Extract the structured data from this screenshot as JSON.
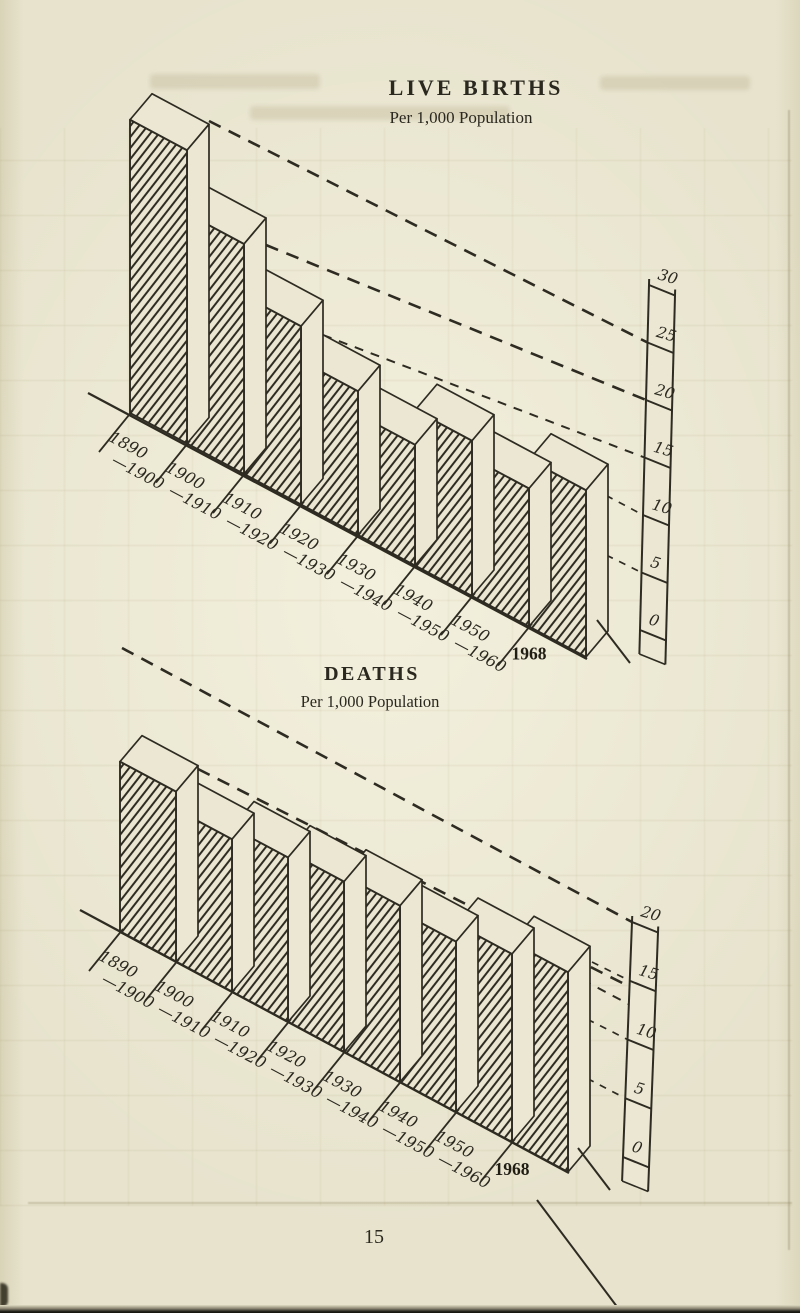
{
  "page": {
    "number": "15"
  },
  "chart_data": [
    {
      "type": "bar",
      "projection": "oblique-3d",
      "title": "LIVE BIRTHS",
      "subtitle": "Per 1,000 Population",
      "categories": [
        "1890–1900",
        "1900–1910",
        "1910–1920",
        "1920–1930",
        "1930–1940",
        "1940–1950",
        "1950–1960",
        "1968"
      ],
      "category_labels": [
        {
          "top": "1890",
          "bottom": "—1900"
        },
        {
          "top": "1900",
          "bottom": "—1910"
        },
        {
          "top": "1910",
          "bottom": "—1920"
        },
        {
          "top": "1920",
          "bottom": "—1930"
        },
        {
          "top": "1930",
          "bottom": "—1940"
        },
        {
          "top": "1940",
          "bottom": "—1950"
        },
        {
          "top": "1950",
          "bottom": "—1960"
        },
        {
          "top": "1968",
          "bottom": ""
        }
      ],
      "values": [
        25.5,
        20,
        15.5,
        12.5,
        10.5,
        13.5,
        12,
        14.5
      ],
      "ylim": [
        0,
        30
      ],
      "yticks": [
        0,
        5,
        10,
        15,
        20,
        25,
        30
      ],
      "grid": false,
      "legend": "none"
    },
    {
      "type": "bar",
      "projection": "oblique-3d",
      "title": "DEATHS",
      "subtitle": "Per 1,000 Population",
      "categories": [
        "1890–1900",
        "1900–1910",
        "1910–1920",
        "1920–1930",
        "1930–1940",
        "1940–1950",
        "1950–1960",
        "1968"
      ],
      "category_labels": [
        {
          "top": "1890",
          "bottom": "—1900"
        },
        {
          "top": "1900",
          "bottom": "—1910"
        },
        {
          "top": "1910",
          "bottom": "—1920"
        },
        {
          "top": "1920",
          "bottom": "—1930"
        },
        {
          "top": "1930",
          "bottom": "—1940"
        },
        {
          "top": "1940",
          "bottom": "—1950"
        },
        {
          "top": "1950",
          "bottom": "—1960"
        },
        {
          "top": "1968",
          "bottom": ""
        }
      ],
      "values": [
        14.5,
        13,
        14,
        14.5,
        15,
        14.5,
        16,
        17
      ],
      "ylim": [
        0,
        20
      ],
      "yticks": [
        0,
        5,
        10,
        15,
        20
      ],
      "grid": false,
      "legend": "none"
    }
  ]
}
